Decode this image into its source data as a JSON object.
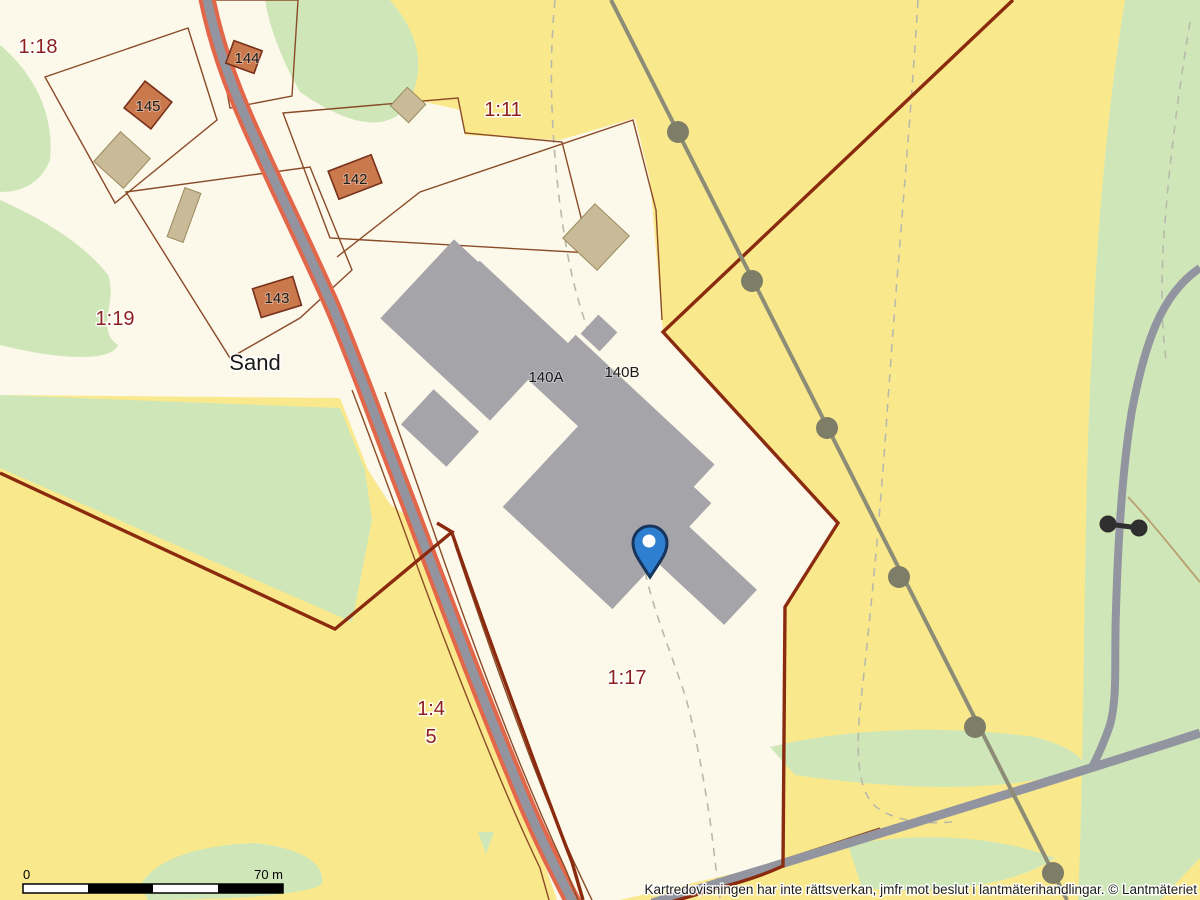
{
  "map": {
    "attribution": "Kartredovisningen har inte rättsverkan, jmfr mot beslut i lantmäterihandlingar. © Lantmäteriet",
    "scale_bar": {
      "zero_label": "0",
      "end_label": "70 m"
    },
    "parcel_labels": {
      "p1_18": "1:18",
      "p1_11": "1:11",
      "p1_19": "1:19",
      "p1_17": "1:17",
      "p1_4": "1:4",
      "p1_4_sub": "5"
    },
    "place_label": "Sand",
    "building_labels": {
      "b145": "145",
      "b144": "144",
      "b142": "142",
      "b143": "143",
      "b140a": "140A",
      "b140b": "140B"
    },
    "marker": {
      "type": "location-pin"
    },
    "colors": {
      "yellow": "#fae98c",
      "cream": "#fcf8ea",
      "green": "#cfe7b8",
      "dash_gray": "#b9b9ab",
      "tan_path": "#b89f72",
      "parcel_line": "#8a4b28",
      "road_gray": "#9295a0",
      "road_orange": "#e2674a",
      "boundary_red": "#8a2a0e",
      "powerline": "#8c8c77",
      "powerline_dot": "#7d7d68",
      "gate_dark": "#2f2f2f",
      "building_gray": "#a5a4a9",
      "building_orange": "#c9794b",
      "building_orange_stroke": "#76301a",
      "building_beige": "#cabb98",
      "building_beige_stroke": "#9a8a5e",
      "label_red": "#8b1f1f",
      "label_black": "#1a1a1a",
      "pin_blue": "#2e7fd0",
      "pin_stroke": "#16345c",
      "halo": "rgba(255,255,255,0.85)"
    }
  }
}
